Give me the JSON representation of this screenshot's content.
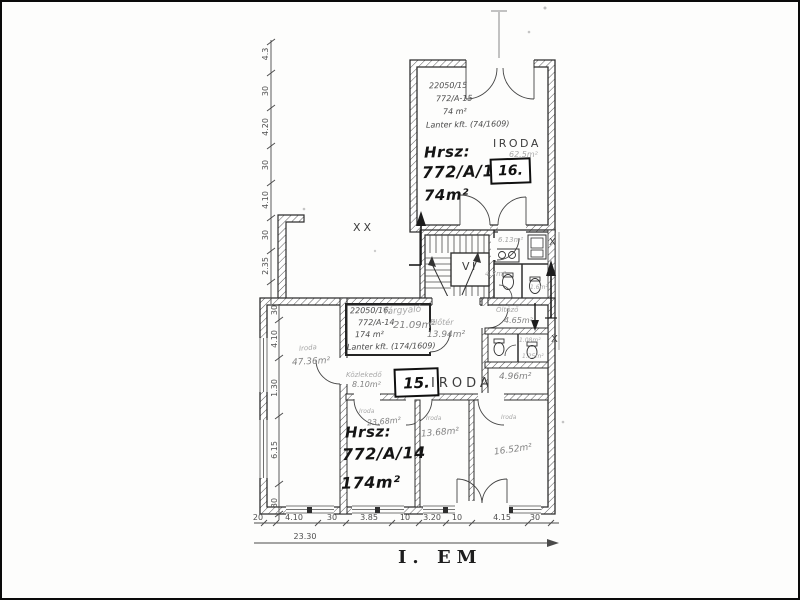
{
  "page": {
    "floor_label": "I. EM",
    "open_area": "XX",
    "stairwell": "VI",
    "section_mark_upper": "X",
    "section_mark_lower": "X"
  },
  "unit16": {
    "note_line1": "22050/15",
    "note_line2": "772/A-15",
    "note_line3": "74 m²",
    "note_line4": "Lanter kft. (74/1609)",
    "room_type": "IRODA",
    "room_area": "62.5m²",
    "hrsz_label": "Hrsz:",
    "parcel": "772/A/15",
    "badge": "16.",
    "total_area": "74m²",
    "eloter_area": "6.13m²",
    "wc_area": "4.7m²",
    "small_area": "1.6m²"
  },
  "unit15": {
    "note_line1": "22050/16.",
    "note_line2": "772/A-14",
    "note_line3": "174 m²",
    "note_line4": "Lanter kft. (174/1609)",
    "room_type": "IRODA",
    "badge": "15.",
    "hrsz_label": "Hrsz:",
    "parcel": "772/A/14",
    "total_area": "174m²",
    "targyalo_name": "Tárgyaló",
    "targyalo_area": "21.09m²",
    "eloter_name": "Előtér",
    "eloter_area": "13.94m²",
    "kozlekedo_name": "Közlekedő",
    "kozlekedo_area": "8.10m²",
    "hall_area": "4.96m²",
    "big_room_name": "Iroda",
    "big_room_area": "47.36m²",
    "oltozo_name": "Öltöző",
    "oltozo_area": "4.65m²",
    "wc1_area": "1.08m²",
    "wc2_area": "1.25m²",
    "office1_name": "Iroda",
    "office1_area": "23.68m²",
    "office2_name": "Iroda",
    "office2_area": "13.68m²",
    "office3_name": "Iroda",
    "office3_area": "16.52m²"
  },
  "dimensions": {
    "left_upper": [
      "4.3",
      "30",
      "4.20",
      "30",
      "4.10",
      "30",
      "2.35"
    ],
    "left_lower": [
      "30",
      "4.10",
      "1.30",
      "6.15",
      "30"
    ],
    "bottom": [
      "20",
      "4.10",
      "30",
      "3.85",
      "10",
      "3.20",
      "10",
      "4.15",
      "30"
    ],
    "bottom_total": "23.30"
  }
}
